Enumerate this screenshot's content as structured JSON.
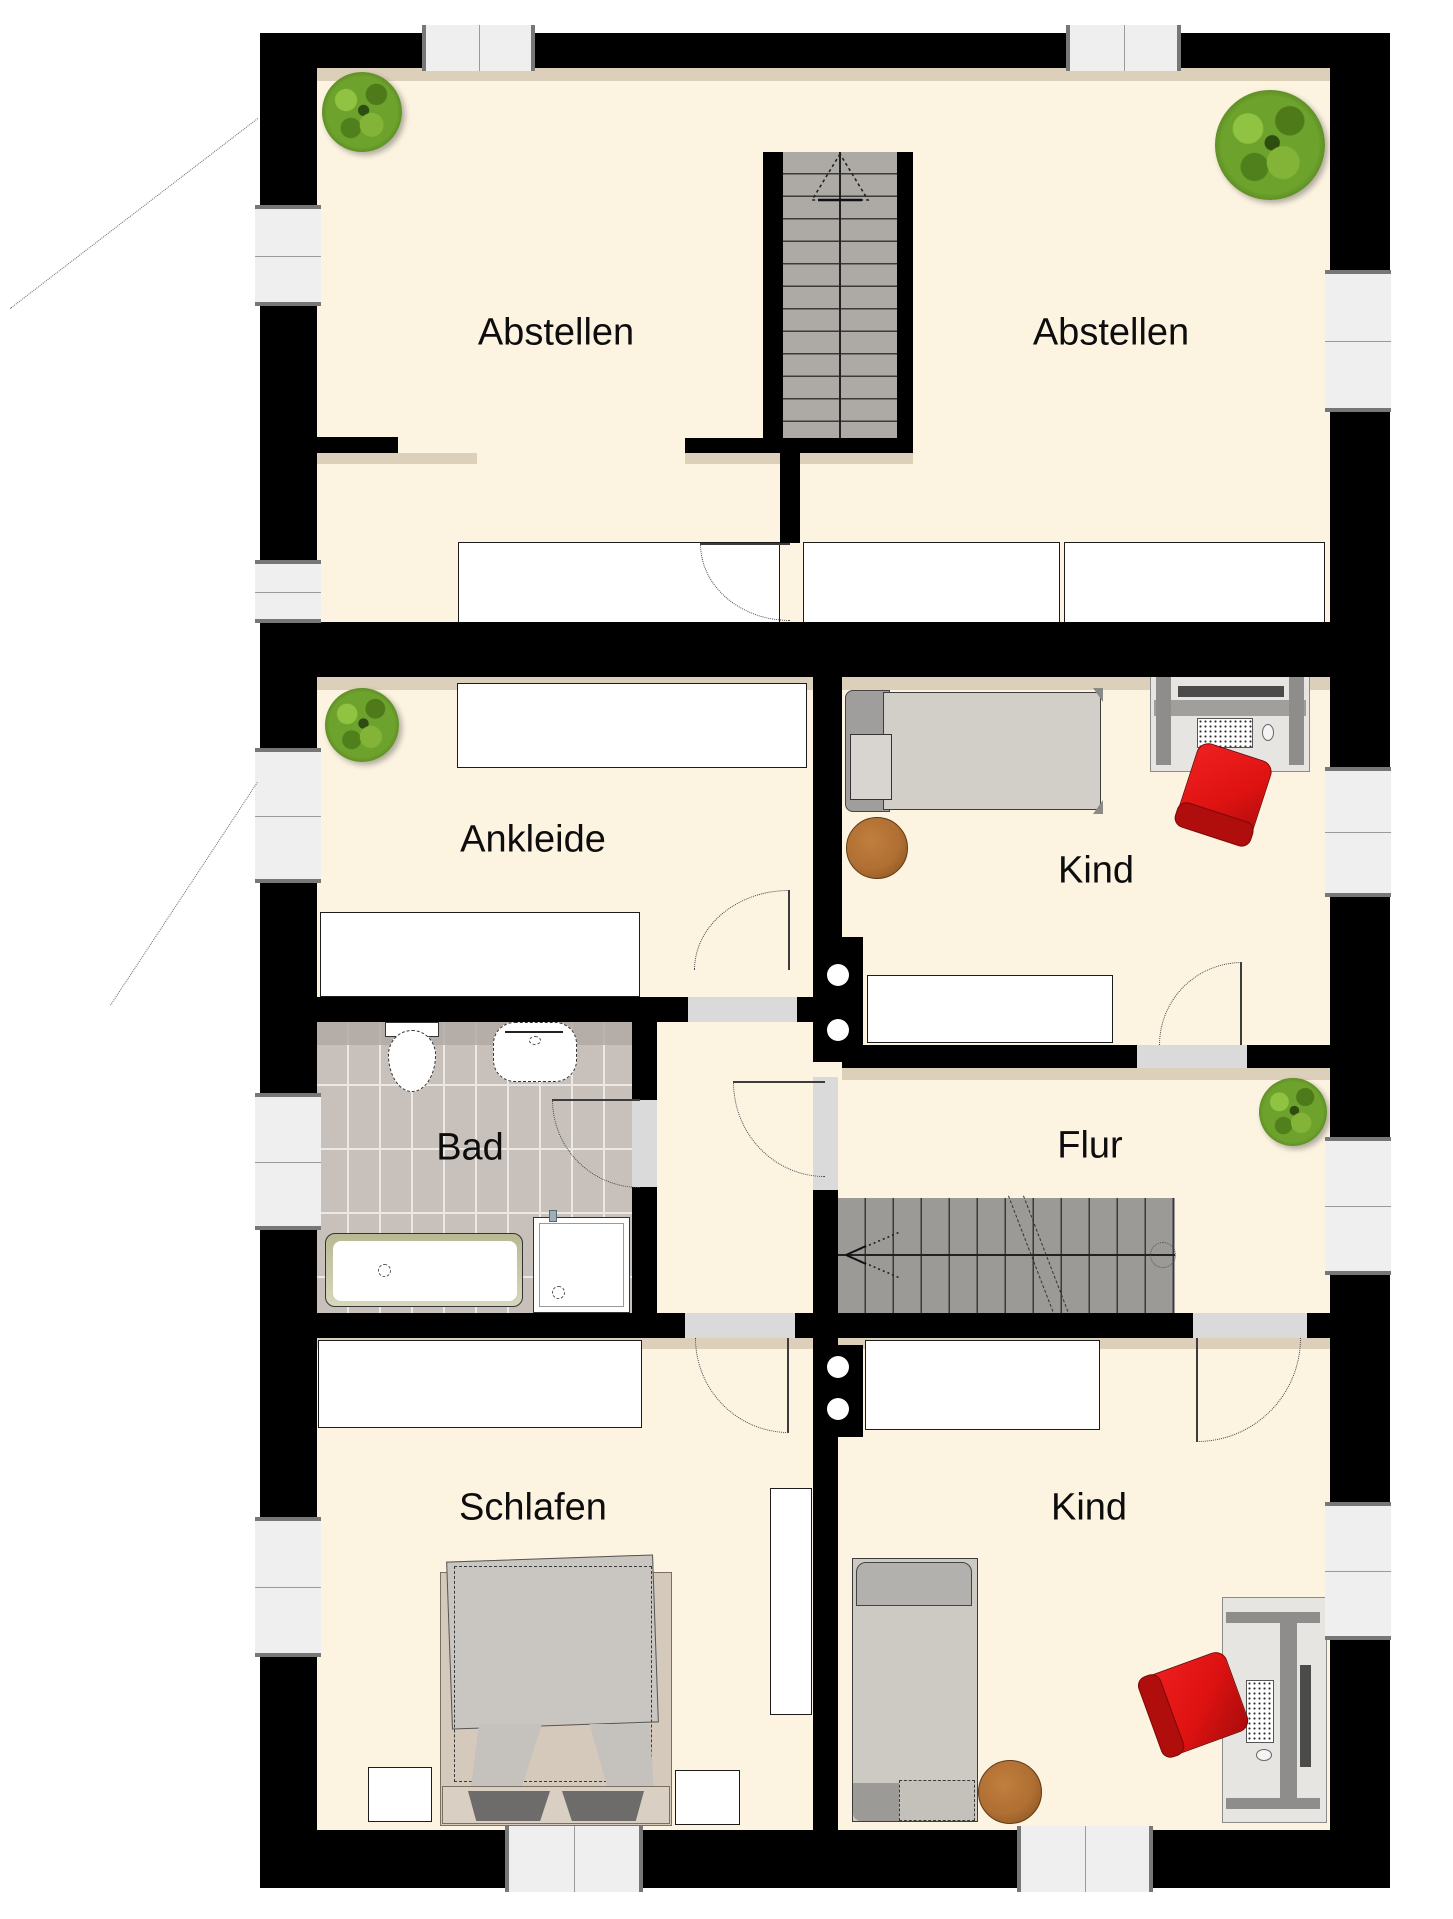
{
  "plan_title": "Obergeschoss Grundriss",
  "rooms": {
    "abstellen_left": {
      "label": "Abstellen"
    },
    "abstellen_right": {
      "label": "Abstellen"
    },
    "ankleide": {
      "label": "Ankleide"
    },
    "kind_top": {
      "label": "Kind"
    },
    "bad": {
      "label": "Bad"
    },
    "flur": {
      "label": "Flur"
    },
    "schlafen": {
      "label": "Schlafen"
    },
    "kind_bottom": {
      "label": "Kind"
    }
  },
  "colors": {
    "floor": "#fcf3e1",
    "wall": "#000000",
    "window_fill": "#efefef",
    "window_frame": "#777777",
    "opening": "#dadada",
    "stairs_top": "#adaaa6",
    "stairs_main": "#9c9a97",
    "tile": "#c8c0ba",
    "tile_dark": "#b2a9a4",
    "furniture": "#ffffff",
    "bed_gray": "#d2cec8",
    "bed_tan": "#d5c9bc",
    "pillow_dark": "#6d6c6a",
    "chair_red": "#df1212",
    "stool_brown": "#b06f33",
    "plant_green": "#6da32d",
    "desk_gray": "#8f8d8b",
    "monitor_dark": "#4b4b49",
    "label_text": "#0d0d0d"
  }
}
